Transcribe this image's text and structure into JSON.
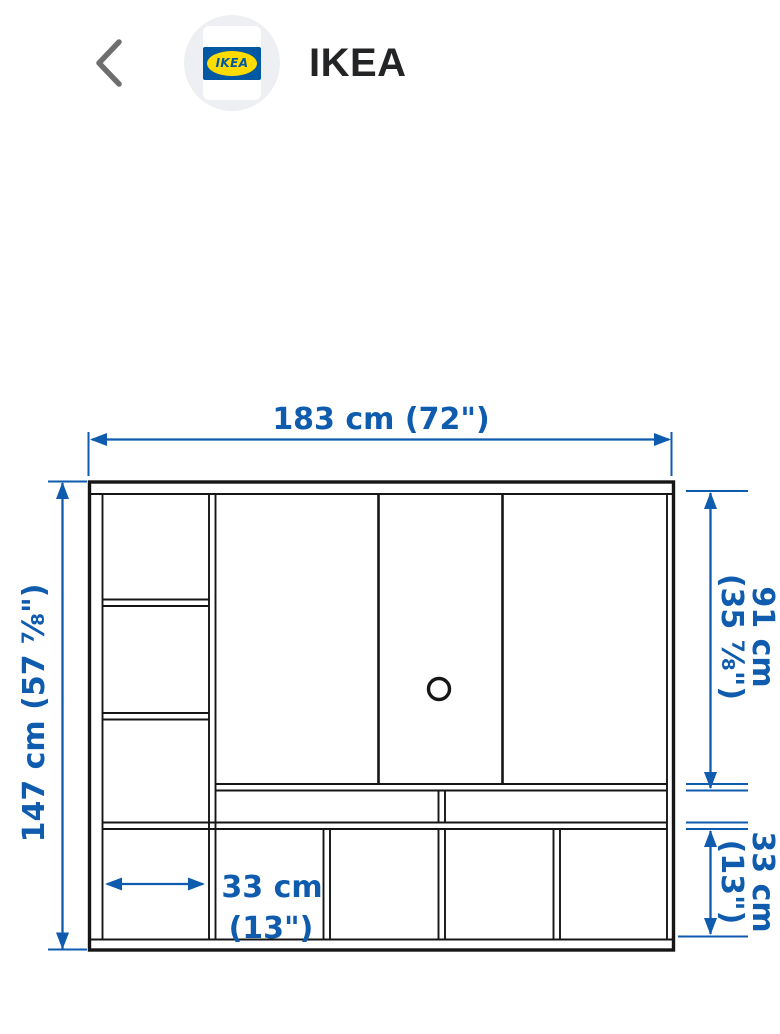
{
  "header": {
    "back_icon": "chevron-left",
    "logo_text": "IKEA",
    "title": "IKEA"
  },
  "diagram": {
    "labels": {
      "total_width": "183 cm (72\")",
      "total_height": "147 cm (57 ⅞\")",
      "upper_height_line1": "91 cm",
      "upper_height_line2": "(35 ⅞\")",
      "lower_height_line1": "33 cm",
      "lower_height_line2": "(13\")",
      "cell_width_line1": "33 cm",
      "cell_width_line2": "(13\")"
    },
    "colors": {
      "dimension_blue": "#0f5bad",
      "outline_black": "#161616",
      "ikea_blue": "#0058a3",
      "ikea_yellow": "#ffdb00"
    }
  }
}
